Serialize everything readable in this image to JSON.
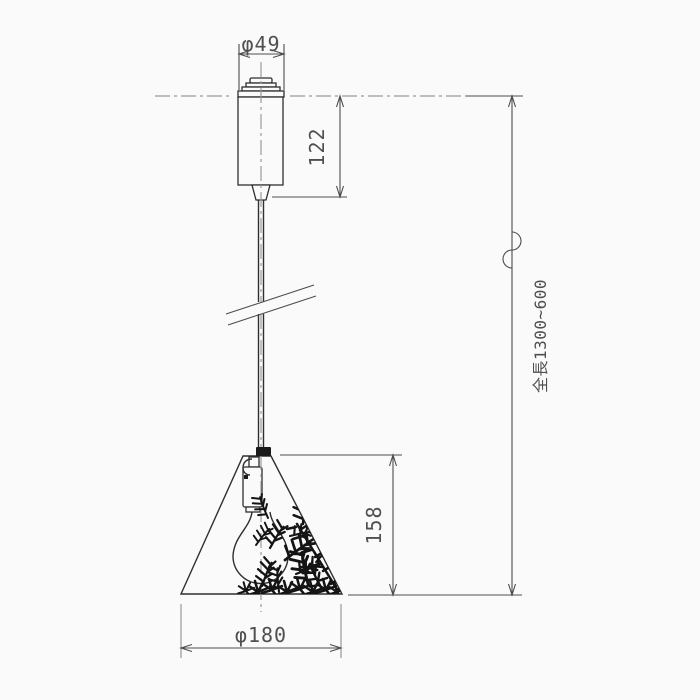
{
  "drawing": {
    "type": "pendant-light-dimension-drawing"
  },
  "dimensions": {
    "canopy_diameter": "φ49",
    "canopy_height": "122",
    "shade_height": "158",
    "shade_diameter": "φ180",
    "overall_length": "全長1300~600"
  },
  "colors": {
    "background": "#fafafa",
    "outline": "#2f2f2f",
    "dimension_line": "#4d4d4d",
    "centerline": "#9b9b9b",
    "extension_line": "#8f8f8f",
    "pattern": "#141414",
    "text": "#4f4f4f"
  }
}
